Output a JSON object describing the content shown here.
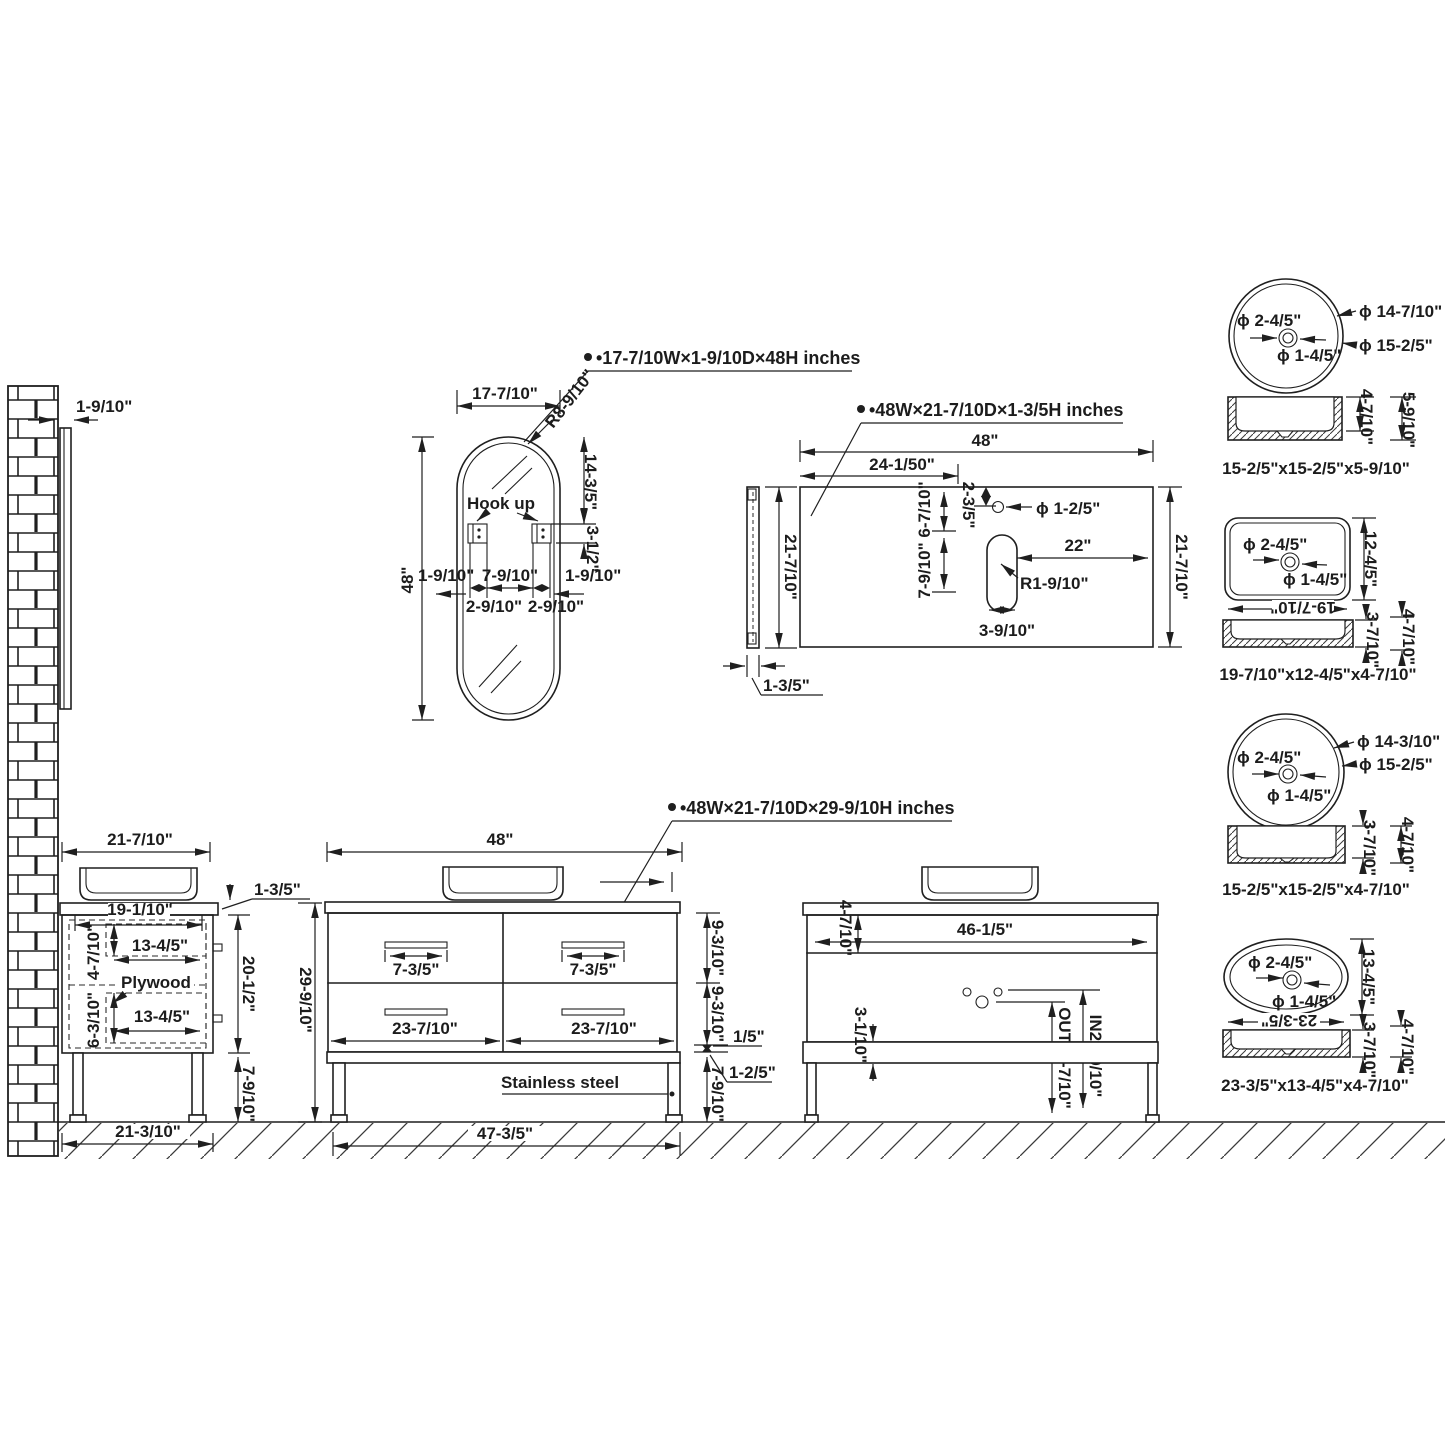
{
  "wall": {
    "gap": "1-9/10\""
  },
  "mirror": {
    "spec": "•17-7/10W×1-9/10D×48H  inches",
    "w": "17-7/10\"",
    "r": "R8-9/10\"",
    "h": "48\"",
    "upper": "14-3/5\"",
    "hook_h": "3-1/2\"",
    "hook": "Hook up",
    "gap_l": "1-9/10\"",
    "between": "7-9/10\"",
    "gap_r": "1-9/10\"",
    "w1": "2-9/10\"",
    "w2": "2-9/10\""
  },
  "counter": {
    "spec": "•48W×21-7/10D×1-3/5H  inches",
    "w": "48\"",
    "half": "24-1/50\"",
    "front": "2-3/5\"",
    "faucet": "ϕ 1-2/5\"",
    "right": "22\"",
    "col": "7-9/10\" 6-7/10\"",
    "slot_r": "R1-9/10\"",
    "slot_w": "3-9/10\"",
    "depth": "21-7/10\"",
    "side_depth": "21-7/10\"",
    "thick": "1-3/5\""
  },
  "sink1": {
    "faucet": "ϕ 2-4/5\"",
    "outer": "ϕ 14-7/10\"",
    "rim": "ϕ 15-2/5\"",
    "drain": "ϕ 1-4/5\"",
    "inner_h": "4-7/10\"",
    "outer_h": "5-9/10\"",
    "caption": "15-2/5\"x15-2/5\"x5-9/10\""
  },
  "sink2": {
    "faucet": "ϕ 2-4/5\"",
    "drain": "ϕ 1-4/5\"",
    "h": "12-4/5\"",
    "w": "19-7/10\"",
    "inner_h": "3-7/10\"",
    "outer_h": "4-7/10\"",
    "caption": "19-7/10\"x12-4/5\"x4-7/10\""
  },
  "sink3": {
    "faucet": "ϕ 2-4/5\"",
    "outer": "ϕ 14-3/10\"",
    "rim": "ϕ 15-2/5\"",
    "drain": "ϕ 1-4/5\"",
    "inner_h": "3-7/10\"",
    "outer_h": "4-7/10\"",
    "caption": "15-2/5\"x15-2/5\"x4-7/10\""
  },
  "sink4": {
    "faucet": "ϕ 2-4/5\"",
    "drain": "ϕ 1-4/5\"",
    "h": "13-4/5\"",
    "w": "23-3/5\"",
    "inner_h": "3-7/10\"",
    "outer_h": "4-7/10\"",
    "caption": "23-3/5\"x13-4/5\"x4-7/10\""
  },
  "side": {
    "top": "21-7/10\"",
    "thick": "1-3/5\"",
    "inner_w": "19-1/10\"",
    "d1h": "4-7/10\"",
    "d1w": "13-4/5\"",
    "ply": "Plywood",
    "d2h": "6-3/10\"",
    "d2w": "13-4/5\"",
    "cab": "20-1/2\"",
    "leg": "7-9/10\"",
    "floor": "21-3/10\""
  },
  "front": {
    "spec": "•48W×21-7/10D×29-9/10H  inches",
    "w": "48\"",
    "h": "29-9/10\"",
    "hl": "7-3/5\"",
    "hr": "7-3/5\"",
    "dl": "23-7/10\"",
    "dr": "23-7/10\"",
    "r1": "9-3/10\"",
    "r2": "9-3/10\"",
    "gap": "1/5\"",
    "rail": "1-2/5\"",
    "leg": "7-9/10\"",
    "mat": "Stainless steel",
    "base": "47-3/5\""
  },
  "back": {
    "top": "4-7/10\"",
    "w": "46-1/5\"",
    "rail": "3-1/10\"",
    "out": "OUT19-7/10\"",
    "in": "IN20-9/10\""
  }
}
